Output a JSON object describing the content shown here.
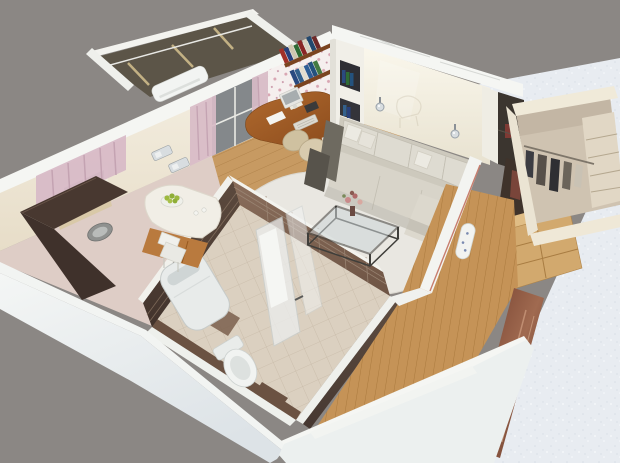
{
  "scene": {
    "type": "3d-isometric-cutaway-render",
    "subject": "studio apartment floor plan, bird's eye cutaway view on gray background",
    "rooms": [
      {
        "id": "balcony",
        "label": "Balcony"
      },
      {
        "id": "kitchen",
        "label": "Kitchen"
      },
      {
        "id": "study",
        "label": "Work area"
      },
      {
        "id": "living",
        "label": "Living room"
      },
      {
        "id": "bathroom",
        "label": "Bathroom"
      },
      {
        "id": "closet",
        "label": "Walk-in closet"
      },
      {
        "id": "hallway",
        "label": "Hallway"
      }
    ],
    "objects": [
      "air-conditioner",
      "pink-curtains",
      "kitchen-window",
      "bar-counter",
      "fruit-bowl",
      "kitchen-sink",
      "dining-chair",
      "kitchen-cabinets",
      "corner-desk",
      "computer-monitor",
      "keyboard",
      "office-chair",
      "bookshelf",
      "shelf-unit",
      "wall-sconces",
      "corner-sofa",
      "pillows",
      "coffee-table",
      "flower-vase",
      "fluffy-rug",
      "washing-machine",
      "toilet",
      "shower-cabin",
      "clothes-rail",
      "garments",
      "ironing-board",
      "hall-shelving",
      "mirror-door",
      "wood-floor",
      "tiled-walls"
    ]
  },
  "palette": {
    "background": "#8b8784",
    "wallTopWhite": "#f5f6f3",
    "wallCream": "#f0e9d8",
    "texturedWall": "#e8ecf1",
    "balconyGlass": "#5c5548",
    "curtainPink": "#d8bbc7",
    "acWhite": "#f2f4f2",
    "windowGlass": "#84888b",
    "floralWallpaper": "#f5efee",
    "shelfWood": "#7a4420",
    "deskWood": "#9c5a26",
    "chairBeige": "#d8cbae",
    "sofaBody": "#d8d4c9",
    "sofaBack": "#cdc9bd",
    "sofaCushion": "#dedbd1",
    "pillow": "#eceae2",
    "armrestDark": "#6e6a60",
    "sideTableDark": "#57534b",
    "rugWhite": "#e9e7e1",
    "coffeeTableFrame": "#3f3e3a",
    "flowerPink": "#c98a8a",
    "counterDark": "#483830",
    "counterDarker": "#3f312b",
    "counterWhite": "#f1eee6",
    "cabinetWood": "#b97a3e",
    "fruitGreen": "#9db83f",
    "kitchenFloor": "#decdc6",
    "woodFloor": "#c79a62",
    "hallFloor": "#c59357",
    "bathFloor": "#dbd0c0",
    "tileBrownLit": "#7d6150",
    "tileBrownDark": "#54443a",
    "washerWhite": "#e8ebea",
    "toiletWhite": "#f1f3f1",
    "showerGlass": "#eceeee",
    "closetWall": "#f0ead9",
    "closetInterior": "#cfc3b1",
    "closetShelf": "#e1d7c5",
    "garmentDark": "#3c3c42",
    "hallShelfWood": "#d2a96e",
    "mirrorDoor": "#6e3a2a",
    "accentRed": "#c06a58",
    "chrome": "#d8dde0",
    "bookColors": [
      "#a03028",
      "#283f7a",
      "#cfc7b0",
      "#2f6b35",
      "#8a2626",
      "#d9d2c2",
      "#23486e",
      "#6e2a2a",
      "#2a4a80",
      "#33608c",
      "#e3ded0",
      "#2e5e96",
      "#24527e",
      "#447a42"
    ]
  }
}
